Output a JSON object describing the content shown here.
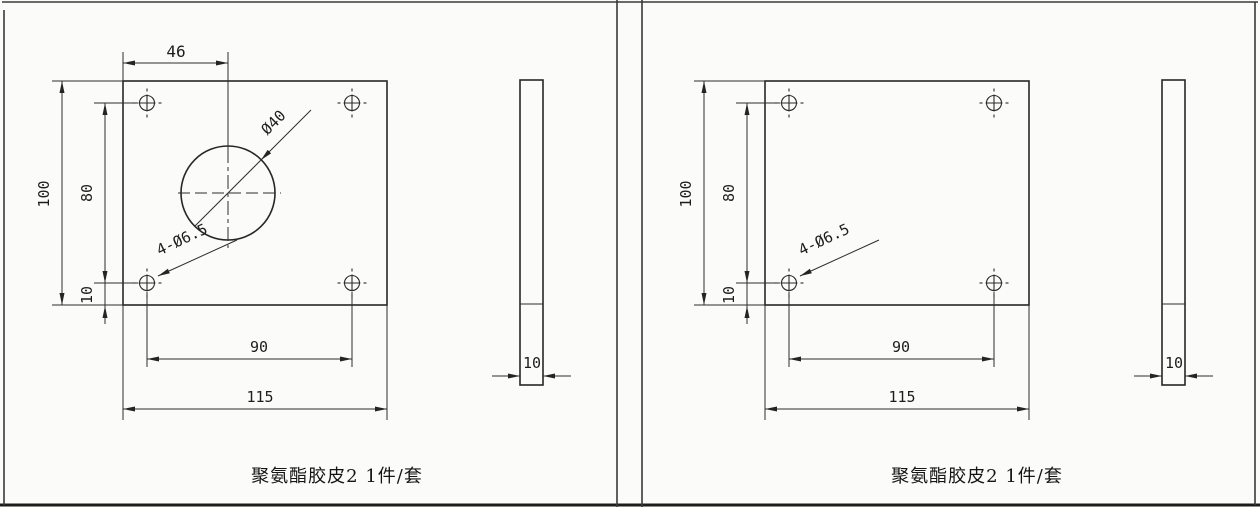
{
  "panels": {
    "left": {
      "caption": "聚氨酯胶皮2 1件/套",
      "dims": {
        "bore_offset": "46",
        "plate_height": "100",
        "hole_row_spacing": "80",
        "hole_edge_margin": "10",
        "hole_col_spacing": "90",
        "plate_width": "115",
        "thickness": "10"
      },
      "labels": {
        "holes_callout": "4-Ø6.5",
        "bore_diameter": "Ø40"
      }
    },
    "right": {
      "caption": "聚氨酯胶皮2 1件/套",
      "dims": {
        "plate_height": "100",
        "hole_row_spacing": "80",
        "hole_edge_margin": "10",
        "hole_col_spacing": "90",
        "plate_width": "115",
        "thickness": "10"
      },
      "labels": {
        "holes_callout": "4-Ø6.5"
      }
    }
  },
  "colors": {
    "line": "#2e2e2e",
    "paper": "#fbfbf9",
    "text": "#1d1d1d"
  }
}
